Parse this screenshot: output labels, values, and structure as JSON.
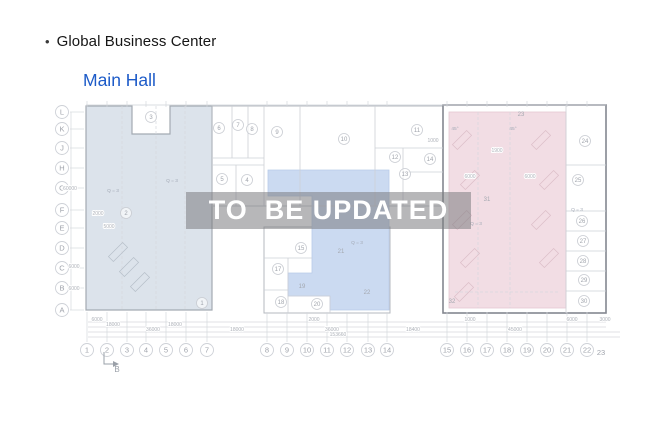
{
  "header": {
    "bullet": "•",
    "title": "Global Business Center",
    "subtitle": "Main Hall"
  },
  "watermark": {
    "text": "TO  BE UPDATED"
  },
  "colors": {
    "subtitle_blue": "#1d5bc8",
    "zone_left": "#dce3eb",
    "zone_middle": "#cbdaf1",
    "zone_right": "#f2dde4",
    "watermark_text": "#ffffff"
  },
  "plan": {
    "row_axis": [
      {
        "label": "L",
        "y": 112
      },
      {
        "label": "K",
        "y": 129
      },
      {
        "label": "J",
        "y": 148
      },
      {
        "label": "H",
        "y": 168
      },
      {
        "label": "G",
        "y": 188
      },
      {
        "label": "F",
        "y": 210
      },
      {
        "label": "E",
        "y": 228
      },
      {
        "label": "D",
        "y": 248
      },
      {
        "label": "C",
        "y": 268
      },
      {
        "label": "B",
        "y": 288
      },
      {
        "label": "A",
        "y": 310
      }
    ],
    "col_axis": [
      {
        "label": "1",
        "x": 87
      },
      {
        "label": "2",
        "x": 107
      },
      {
        "label": "3",
        "x": 127
      },
      {
        "label": "4",
        "x": 146
      },
      {
        "label": "5",
        "x": 166
      },
      {
        "label": "6",
        "x": 186
      },
      {
        "label": "7",
        "x": 207
      },
      {
        "label": "8",
        "x": 267
      },
      {
        "label": "9",
        "x": 287
      },
      {
        "label": "10",
        "x": 307
      },
      {
        "label": "11",
        "x": 327
      },
      {
        "label": "12",
        "x": 347
      },
      {
        "label": "13",
        "x": 368
      },
      {
        "label": "14",
        "x": 387
      },
      {
        "label": "15",
        "x": 447
      },
      {
        "label": "16",
        "x": 467
      },
      {
        "label": "17",
        "x": 487
      },
      {
        "label": "18",
        "x": 507
      },
      {
        "label": "19",
        "x": 527
      },
      {
        "label": "20",
        "x": 547
      },
      {
        "label": "21",
        "x": 567
      },
      {
        "label": "22",
        "x": 587
      },
      {
        "label": "23",
        "x": 601,
        "y": 355,
        "plain": true
      }
    ],
    "rooms": [
      {
        "n": "1",
        "x": 202,
        "y": 303
      },
      {
        "n": "2",
        "x": 126,
        "y": 213
      },
      {
        "n": "3",
        "x": 151,
        "y": 117
      },
      {
        "n": "4",
        "x": 247,
        "y": 180
      },
      {
        "n": "5",
        "x": 222,
        "y": 179
      },
      {
        "n": "6",
        "x": 219,
        "y": 128
      },
      {
        "n": "7",
        "x": 238,
        "y": 125
      },
      {
        "n": "8",
        "x": 252,
        "y": 129
      },
      {
        "n": "9",
        "x": 277,
        "y": 132
      },
      {
        "n": "10",
        "x": 344,
        "y": 139
      },
      {
        "n": "11",
        "x": 417,
        "y": 130
      },
      {
        "n": "12",
        "x": 395,
        "y": 157
      },
      {
        "n": "13",
        "x": 405,
        "y": 174
      },
      {
        "n": "14",
        "x": 430,
        "y": 159
      },
      {
        "n": "15",
        "x": 301,
        "y": 248
      },
      {
        "n": "17",
        "x": 278,
        "y": 269
      },
      {
        "n": "18",
        "x": 281,
        "y": 302
      },
      {
        "n": "20",
        "x": 317,
        "y": 304
      },
      {
        "n": "24",
        "x": 585,
        "y": 141
      },
      {
        "n": "25",
        "x": 578,
        "y": 180
      },
      {
        "n": "26",
        "x": 582,
        "y": 221
      },
      {
        "n": "27",
        "x": 583,
        "y": 241
      },
      {
        "n": "28",
        "x": 583,
        "y": 261
      },
      {
        "n": "29",
        "x": 584,
        "y": 280
      },
      {
        "n": "30",
        "x": 584,
        "y": 301
      }
    ],
    "plain_labels": [
      {
        "t": "19",
        "x": 302,
        "y": 288
      },
      {
        "t": "21",
        "x": 341,
        "y": 253
      },
      {
        "t": "22",
        "x": 367,
        "y": 294
      },
      {
        "t": "23",
        "x": 521,
        "y": 116
      },
      {
        "t": "31",
        "x": 487,
        "y": 201
      },
      {
        "t": "32",
        "x": 452,
        "y": 303
      }
    ],
    "annotations": [
      {
        "t": "Q = 3",
        "x": 113,
        "y": 192
      },
      {
        "t": "Q = 3",
        "x": 172,
        "y": 182
      },
      {
        "t": "Q = 3",
        "x": 357,
        "y": 244
      },
      {
        "t": "Q = 3",
        "x": 476,
        "y": 225
      },
      {
        "t": "Q = 3",
        "x": 577,
        "y": 211
      },
      {
        "t": "45°",
        "x": 455,
        "y": 130
      },
      {
        "t": "45°",
        "x": 513,
        "y": 130
      }
    ],
    "dim_texts": [
      {
        "t": "6000",
        "x": 97,
        "y": 321
      },
      {
        "t": "18000",
        "x": 113,
        "y": 326
      },
      {
        "t": "18000",
        "x": 175,
        "y": 326
      },
      {
        "t": "36000",
        "x": 153,
        "y": 331
      },
      {
        "t": "18000",
        "x": 237,
        "y": 331
      },
      {
        "t": "2000",
        "x": 314,
        "y": 321
      },
      {
        "t": "36000",
        "x": 332,
        "y": 331
      },
      {
        "t": "153660",
        "x": 338,
        "y": 336
      },
      {
        "t": "1000",
        "x": 470,
        "y": 321
      },
      {
        "t": "6000",
        "x": 572,
        "y": 321
      },
      {
        "t": "3000",
        "x": 605,
        "y": 321
      },
      {
        "t": "18400",
        "x": 413,
        "y": 331
      },
      {
        "t": "45000",
        "x": 515,
        "y": 331
      },
      {
        "t": "60000",
        "x": 70,
        "y": 190,
        "r": -90
      },
      {
        "t": "6000",
        "x": 74,
        "y": 268,
        "r": -90
      },
      {
        "t": "6000",
        "x": 74,
        "y": 290,
        "r": -90
      },
      {
        "t": "5000",
        "x": 109,
        "y": 228,
        "r": -90
      },
      {
        "t": "2000",
        "x": 98,
        "y": 215
      },
      {
        "t": "1000",
        "x": 433,
        "y": 142
      },
      {
        "t": "1900",
        "x": 497,
        "y": 152
      },
      {
        "t": "6000",
        "x": 470,
        "y": 178,
        "r": -90
      },
      {
        "t": "6000",
        "x": 530,
        "y": 178,
        "r": -90
      }
    ],
    "section_marker": {
      "label": "B"
    }
  }
}
